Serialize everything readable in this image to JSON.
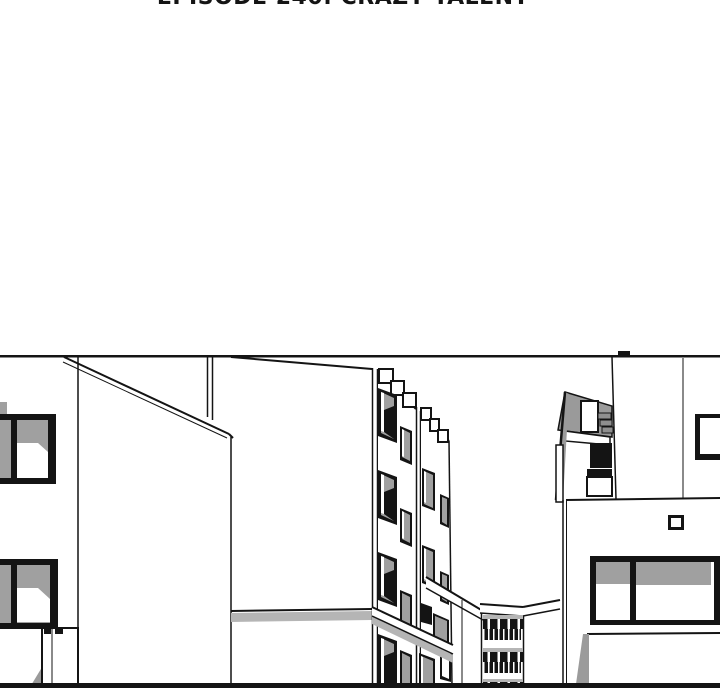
{
  "header": {
    "episode_title": "EPISODE 240: CRAZY TALENT"
  },
  "panel": {
    "type": "comic-art-panel",
    "scene": "black-and-white line drawing of a street between white multi-story buildings",
    "elements": [
      "left-building",
      "left-building-window-upper",
      "left-building-window-lower",
      "left-building-door",
      "diagonal-roof-edge",
      "roof-pipe",
      "mid-wall",
      "mid-tall-building",
      "stepped-parapet",
      "perspective-windows",
      "street-cap-wall",
      "low-balcony-building",
      "balcony-railings",
      "rooftop-penthouse",
      "right-building",
      "storefront-window",
      "small-square-window",
      "upper-corner-window"
    ]
  },
  "palette": {
    "ink": "#141414",
    "paper": "#ffffff",
    "glass_gray": "#a0a0a0",
    "shadow_gray": "#b5b5b5",
    "roof_gray": "#9a9a9a"
  }
}
